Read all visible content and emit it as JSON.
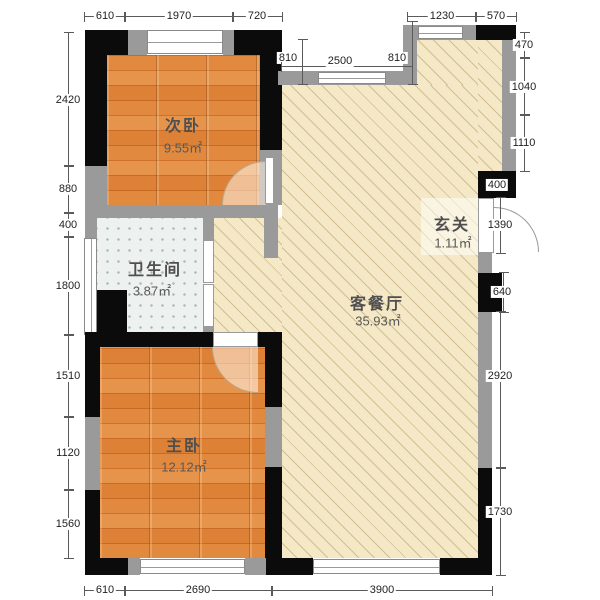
{
  "plan_title": "two-bedroom floor plan",
  "rooms": {
    "secondary_bedroom": {
      "name": "次卧",
      "area": "9.55㎡"
    },
    "bathroom": {
      "name": "卫生间",
      "area": "3.87㎡"
    },
    "master_bedroom": {
      "name": "主卧",
      "area": "12.12㎡"
    },
    "living_dining": {
      "name": "客餐厅",
      "area": "35.93㎡"
    },
    "foyer": {
      "name": "玄关",
      "area": "1.11㎡"
    }
  },
  "dims": {
    "t610": "610",
    "t1970": "1970",
    "t720": "720",
    "t1230": "1230",
    "t570": "570",
    "i810l": "810",
    "i2500": "2500",
    "i810r": "810",
    "l2420": "2420",
    "l880": "880",
    "l400": "400",
    "l1800": "1800",
    "l1510": "1510",
    "l1120": "1120",
    "l1560": "1560",
    "r470": "470",
    "r1040": "1040",
    "r1110": "1110",
    "r400": "400",
    "r1390": "1390",
    "r640": "640",
    "r2920": "2920",
    "r1730": "1730",
    "b610": "610",
    "b2690": "2690",
    "b3900": "3900"
  },
  "colors": {
    "wall_black": "#0b0b0b",
    "wall_gray": "#9a9a9a",
    "wood_floor": "#d97a2e",
    "living_floor": "#f4e8c6",
    "tile_floor": "#edf1ef"
  }
}
